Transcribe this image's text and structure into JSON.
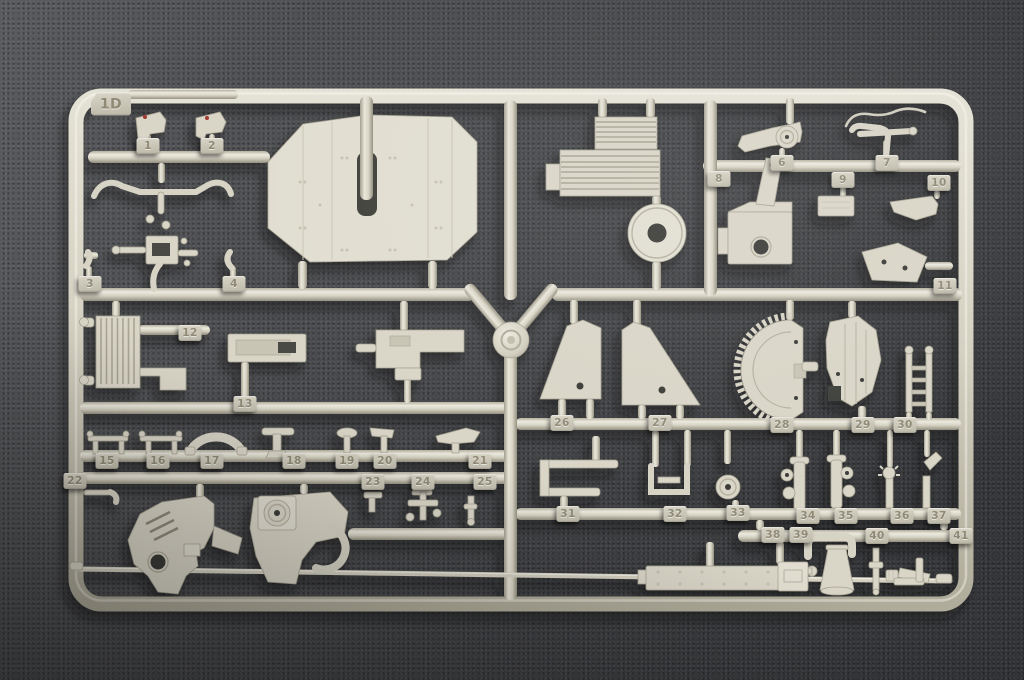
{
  "sprue": {
    "corner_tag": "1D",
    "part_tags": [
      {
        "label": "1",
        "x": 148,
        "y": 146
      },
      {
        "label": "2",
        "x": 212,
        "y": 146
      },
      {
        "label": "3",
        "x": 90,
        "y": 284
      },
      {
        "label": "4",
        "x": 234,
        "y": 284
      },
      {
        "label": "6",
        "x": 782,
        "y": 163
      },
      {
        "label": "7",
        "x": 887,
        "y": 163
      },
      {
        "label": "8",
        "x": 719,
        "y": 179
      },
      {
        "label": "9",
        "x": 843,
        "y": 180
      },
      {
        "label": "10",
        "x": 939,
        "y": 183
      },
      {
        "label": "11",
        "x": 945,
        "y": 286
      },
      {
        "label": "12",
        "x": 190,
        "y": 333
      },
      {
        "label": "13",
        "x": 245,
        "y": 404
      },
      {
        "label": "15",
        "x": 107,
        "y": 461
      },
      {
        "label": "16",
        "x": 158,
        "y": 461
      },
      {
        "label": "17",
        "x": 212,
        "y": 461
      },
      {
        "label": "18",
        "x": 294,
        "y": 461
      },
      {
        "label": "19",
        "x": 347,
        "y": 461
      },
      {
        "label": "20",
        "x": 385,
        "y": 461
      },
      {
        "label": "21",
        "x": 480,
        "y": 461
      },
      {
        "label": "22",
        "x": 75,
        "y": 481
      },
      {
        "label": "23",
        "x": 373,
        "y": 482
      },
      {
        "label": "24",
        "x": 423,
        "y": 482
      },
      {
        "label": "25",
        "x": 485,
        "y": 482
      },
      {
        "label": "26",
        "x": 562,
        "y": 423
      },
      {
        "label": "27",
        "x": 660,
        "y": 423
      },
      {
        "label": "28",
        "x": 782,
        "y": 425
      },
      {
        "label": "29",
        "x": 863,
        "y": 425
      },
      {
        "label": "30",
        "x": 905,
        "y": 425
      },
      {
        "label": "31",
        "x": 568,
        "y": 514
      },
      {
        "label": "32",
        "x": 675,
        "y": 514
      },
      {
        "label": "33",
        "x": 738,
        "y": 513
      },
      {
        "label": "34",
        "x": 808,
        "y": 516
      },
      {
        "label": "35",
        "x": 846,
        "y": 516
      },
      {
        "label": "36",
        "x": 902,
        "y": 516
      },
      {
        "label": "37",
        "x": 939,
        "y": 516
      },
      {
        "label": "38",
        "x": 773,
        "y": 535
      },
      {
        "label": "39",
        "x": 801,
        "y": 535
      },
      {
        "label": "40",
        "x": 877,
        "y": 536
      },
      {
        "label": "41",
        "x": 961,
        "y": 536
      }
    ],
    "colors": {
      "plastic": "#d9d5c7",
      "plastic_highlight": "#efede1",
      "plastic_shadow": "#94907f",
      "tag_face": "#cdc9ba",
      "tag_numeral": "#8e8a76",
      "background_felt": "#454648",
      "red_paint_dot": "#a23a32"
    }
  }
}
